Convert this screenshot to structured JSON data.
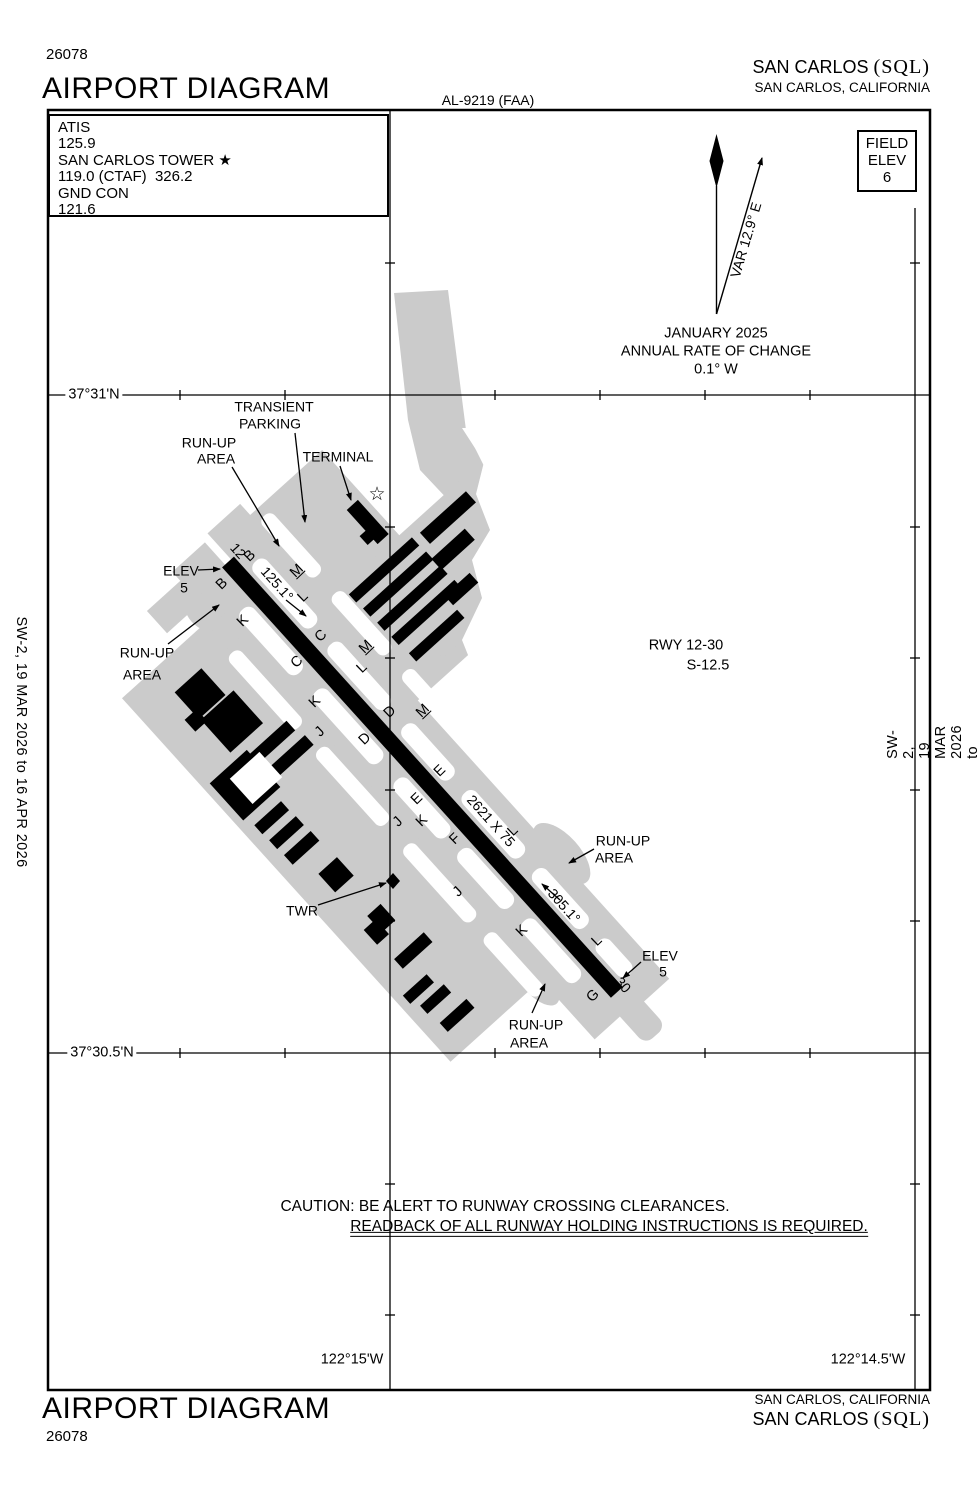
{
  "header": {
    "plate_number": "26078",
    "title": "AIRPORT DIAGRAM",
    "al_number": "AL-9219 (FAA)",
    "airport_name": "SAN CARLOS ",
    "airport_icao": "(SQL)",
    "city_state": "SAN CARLOS, CALIFORNIA"
  },
  "footer": {
    "title": "AIRPORT DIAGRAM",
    "plate_number": "26078",
    "city_state": "SAN CARLOS, CALIFORNIA",
    "airport_name": "SAN CARLOS ",
    "airport_icao": "(SQL)"
  },
  "comms": {
    "atis_label": "ATIS",
    "atis_freq": "125.9",
    "tower_label": "SAN CARLOS TOWER",
    "tower_star": "★",
    "tower_freq": "119.0 (CTAF)  326.2",
    "gnd_label": "GND CON",
    "gnd_freq": "121.6"
  },
  "field_elev": {
    "line1": "FIELD",
    "line2": "ELEV",
    "value": "6"
  },
  "edge_note": "SW-2,  19 MAR 2026  to  16 APR 2026",
  "caution": {
    "line1": "CAUTION: BE ALERT TO RUNWAY CROSSING CLEARANCES.",
    "line2": "READBACK OF ALL RUNWAY HOLDING INSTRUCTIONS IS REQUIRED."
  },
  "grid": {
    "lat_top": "37°31'N",
    "lat_bottom": "37°30.5'N",
    "lon_left": "122°15'W",
    "lon_right": "122°14.5'W"
  },
  "runway_info": {
    "line1": "RWY 12-30",
    "line2": "S-12.5"
  },
  "variation": {
    "var_label": "VAR 12.9° E",
    "date": "JANUARY 2025",
    "rate_label": "ANNUAL RATE OF CHANGE",
    "rate_value": "0.1° W"
  },
  "diagram_texts": [
    {
      "name": "transient-parking-label-1",
      "text": "TRANSIENT",
      "x": 274,
      "y": 407
    },
    {
      "name": "transient-parking-label-2",
      "text": "PARKING",
      "x": 270,
      "y": 424
    },
    {
      "name": "runup-area-nw-label-1",
      "text": "RUN-UP",
      "x": 209,
      "y": 443
    },
    {
      "name": "runup-area-nw-label-2",
      "text": "AREA",
      "x": 216,
      "y": 459
    },
    {
      "name": "terminal-label",
      "text": "TERMINAL",
      "x": 338,
      "y": 457
    },
    {
      "name": "elev-12-label",
      "text": "ELEV",
      "x": 181,
      "y": 571
    },
    {
      "name": "elev-12-value",
      "text": "5",
      "x": 184,
      "y": 588
    },
    {
      "name": "runup-area-w-label-1",
      "text": "RUN-UP",
      "x": 147,
      "y": 653
    },
    {
      "name": "runup-area-w-label-2",
      "text": "AREA",
      "x": 142,
      "y": 675
    },
    {
      "name": "twr-label",
      "text": "TWR",
      "x": 302,
      "y": 911
    },
    {
      "name": "runup-area-e-label-1",
      "text": "RUN-UP",
      "x": 623,
      "y": 841
    },
    {
      "name": "runup-area-e-label-2",
      "text": "AREA",
      "x": 614,
      "y": 858
    },
    {
      "name": "elev-30-label",
      "text": "ELEV",
      "x": 660,
      "y": 956
    },
    {
      "name": "elev-30-value",
      "text": "5",
      "x": 663,
      "y": 972
    },
    {
      "name": "runup-area-s-label-1",
      "text": "RUN-UP",
      "x": 536,
      "y": 1025
    },
    {
      "name": "runup-area-s-label-2",
      "text": "AREA",
      "x": 529,
      "y": 1043
    },
    {
      "name": "rwy-info-line1",
      "text": "RWY 12-30",
      "x": 686,
      "y": 646,
      "fs": 14.5
    },
    {
      "name": "rwy-info-line2",
      "text": "S-12.5",
      "x": 708,
      "y": 666,
      "fs": 14.5
    },
    {
      "name": "runway-number-12",
      "text": "12",
      "x": 238,
      "y": 551,
      "rot": 48,
      "fs": 14
    },
    {
      "name": "runway-number-30",
      "text": "30",
      "x": 623,
      "y": 985,
      "rot": 48,
      "fs": 14
    },
    {
      "name": "runway-heading-12",
      "text": "125.1°",
      "x": 277,
      "y": 584,
      "rot": 48
    },
    {
      "name": "runway-heading-30",
      "text": "305.1°",
      "x": 564,
      "y": 906,
      "rot": 48
    },
    {
      "name": "runway-dimensions",
      "text": "2621 X 75",
      "x": 491,
      "y": 821,
      "rot": 48
    },
    {
      "name": "airport-beacon-star-icon",
      "text": "☆",
      "x": 377,
      "y": 495,
      "fs": 19
    },
    {
      "name": "var-label",
      "text": "VAR 12.9° E",
      "x": 746,
      "y": 240,
      "rot": -73.5
    },
    {
      "name": "variation-date",
      "text": "JANUARY 2025",
      "x": 716,
      "y": 334,
      "fs": 14.5
    },
    {
      "name": "variation-rate-label",
      "text": "ANNUAL RATE OF CHANGE",
      "x": 716,
      "y": 352,
      "fs": 14.5
    },
    {
      "name": "variation-rate-value",
      "text": "0.1° W",
      "x": 716,
      "y": 370,
      "fs": 14.5
    },
    {
      "name": "lat-top-label",
      "text": "37°31'N",
      "x": 94,
      "y": 395,
      "fs": 14.5,
      "bg": true
    },
    {
      "name": "lat-bottom-label",
      "text": "37°30.5'N",
      "x": 102,
      "y": 1053,
      "fs": 14.5,
      "bg": true
    },
    {
      "name": "lon-left-label",
      "text": "122°15'W",
      "x": 352,
      "y": 1360,
      "fs": 14.5
    },
    {
      "name": "lon-right-label",
      "text": "122°14.5'W",
      "x": 868,
      "y": 1360,
      "fs": 14.5
    },
    {
      "name": "caution-line1",
      "text": "CAUTION: BE ALERT TO RUNWAY CROSSING CLEARANCES.",
      "x": 505,
      "y": 1207,
      "fs": 15.5
    },
    {
      "name": "caution-line2",
      "text": "READBACK OF ALL RUNWAY HOLDING INSTRUCTIONS IS REQUIRED.",
      "x": 609,
      "y": 1228,
      "fs": 15.5,
      "u": true
    }
  ],
  "taxiway_labels": [
    {
      "label": "B",
      "x": 250,
      "y": 556
    },
    {
      "label": "B",
      "x": 222,
      "y": 584
    },
    {
      "label": "M",
      "x": 297,
      "y": 571,
      "u": true
    },
    {
      "label": "L",
      "x": 303,
      "y": 597
    },
    {
      "label": "K",
      "x": 243,
      "y": 621
    },
    {
      "label": "C",
      "x": 321,
      "y": 636
    },
    {
      "label": "C",
      "x": 297,
      "y": 662
    },
    {
      "label": "M",
      "x": 366,
      "y": 647,
      "u": true
    },
    {
      "label": "L",
      "x": 362,
      "y": 668
    },
    {
      "label": "K",
      "x": 315,
      "y": 702
    },
    {
      "label": "J",
      "x": 320,
      "y": 732
    },
    {
      "label": "D",
      "x": 390,
      "y": 712
    },
    {
      "label": "M",
      "x": 423,
      "y": 711,
      "u": true
    },
    {
      "label": "D",
      "x": 365,
      "y": 739
    },
    {
      "label": "E",
      "x": 440,
      "y": 771
    },
    {
      "label": "E",
      "x": 417,
      "y": 799
    },
    {
      "label": "J",
      "x": 398,
      "y": 822
    },
    {
      "label": "K",
      "x": 422,
      "y": 821
    },
    {
      "label": "F",
      "x": 455,
      "y": 839
    },
    {
      "label": "L",
      "x": 513,
      "y": 831
    },
    {
      "label": "J",
      "x": 458,
      "y": 892
    },
    {
      "label": "K",
      "x": 522,
      "y": 931
    },
    {
      "label": "L",
      "x": 597,
      "y": 941
    },
    {
      "label": "G",
      "x": 593,
      "y": 996
    }
  ]
}
